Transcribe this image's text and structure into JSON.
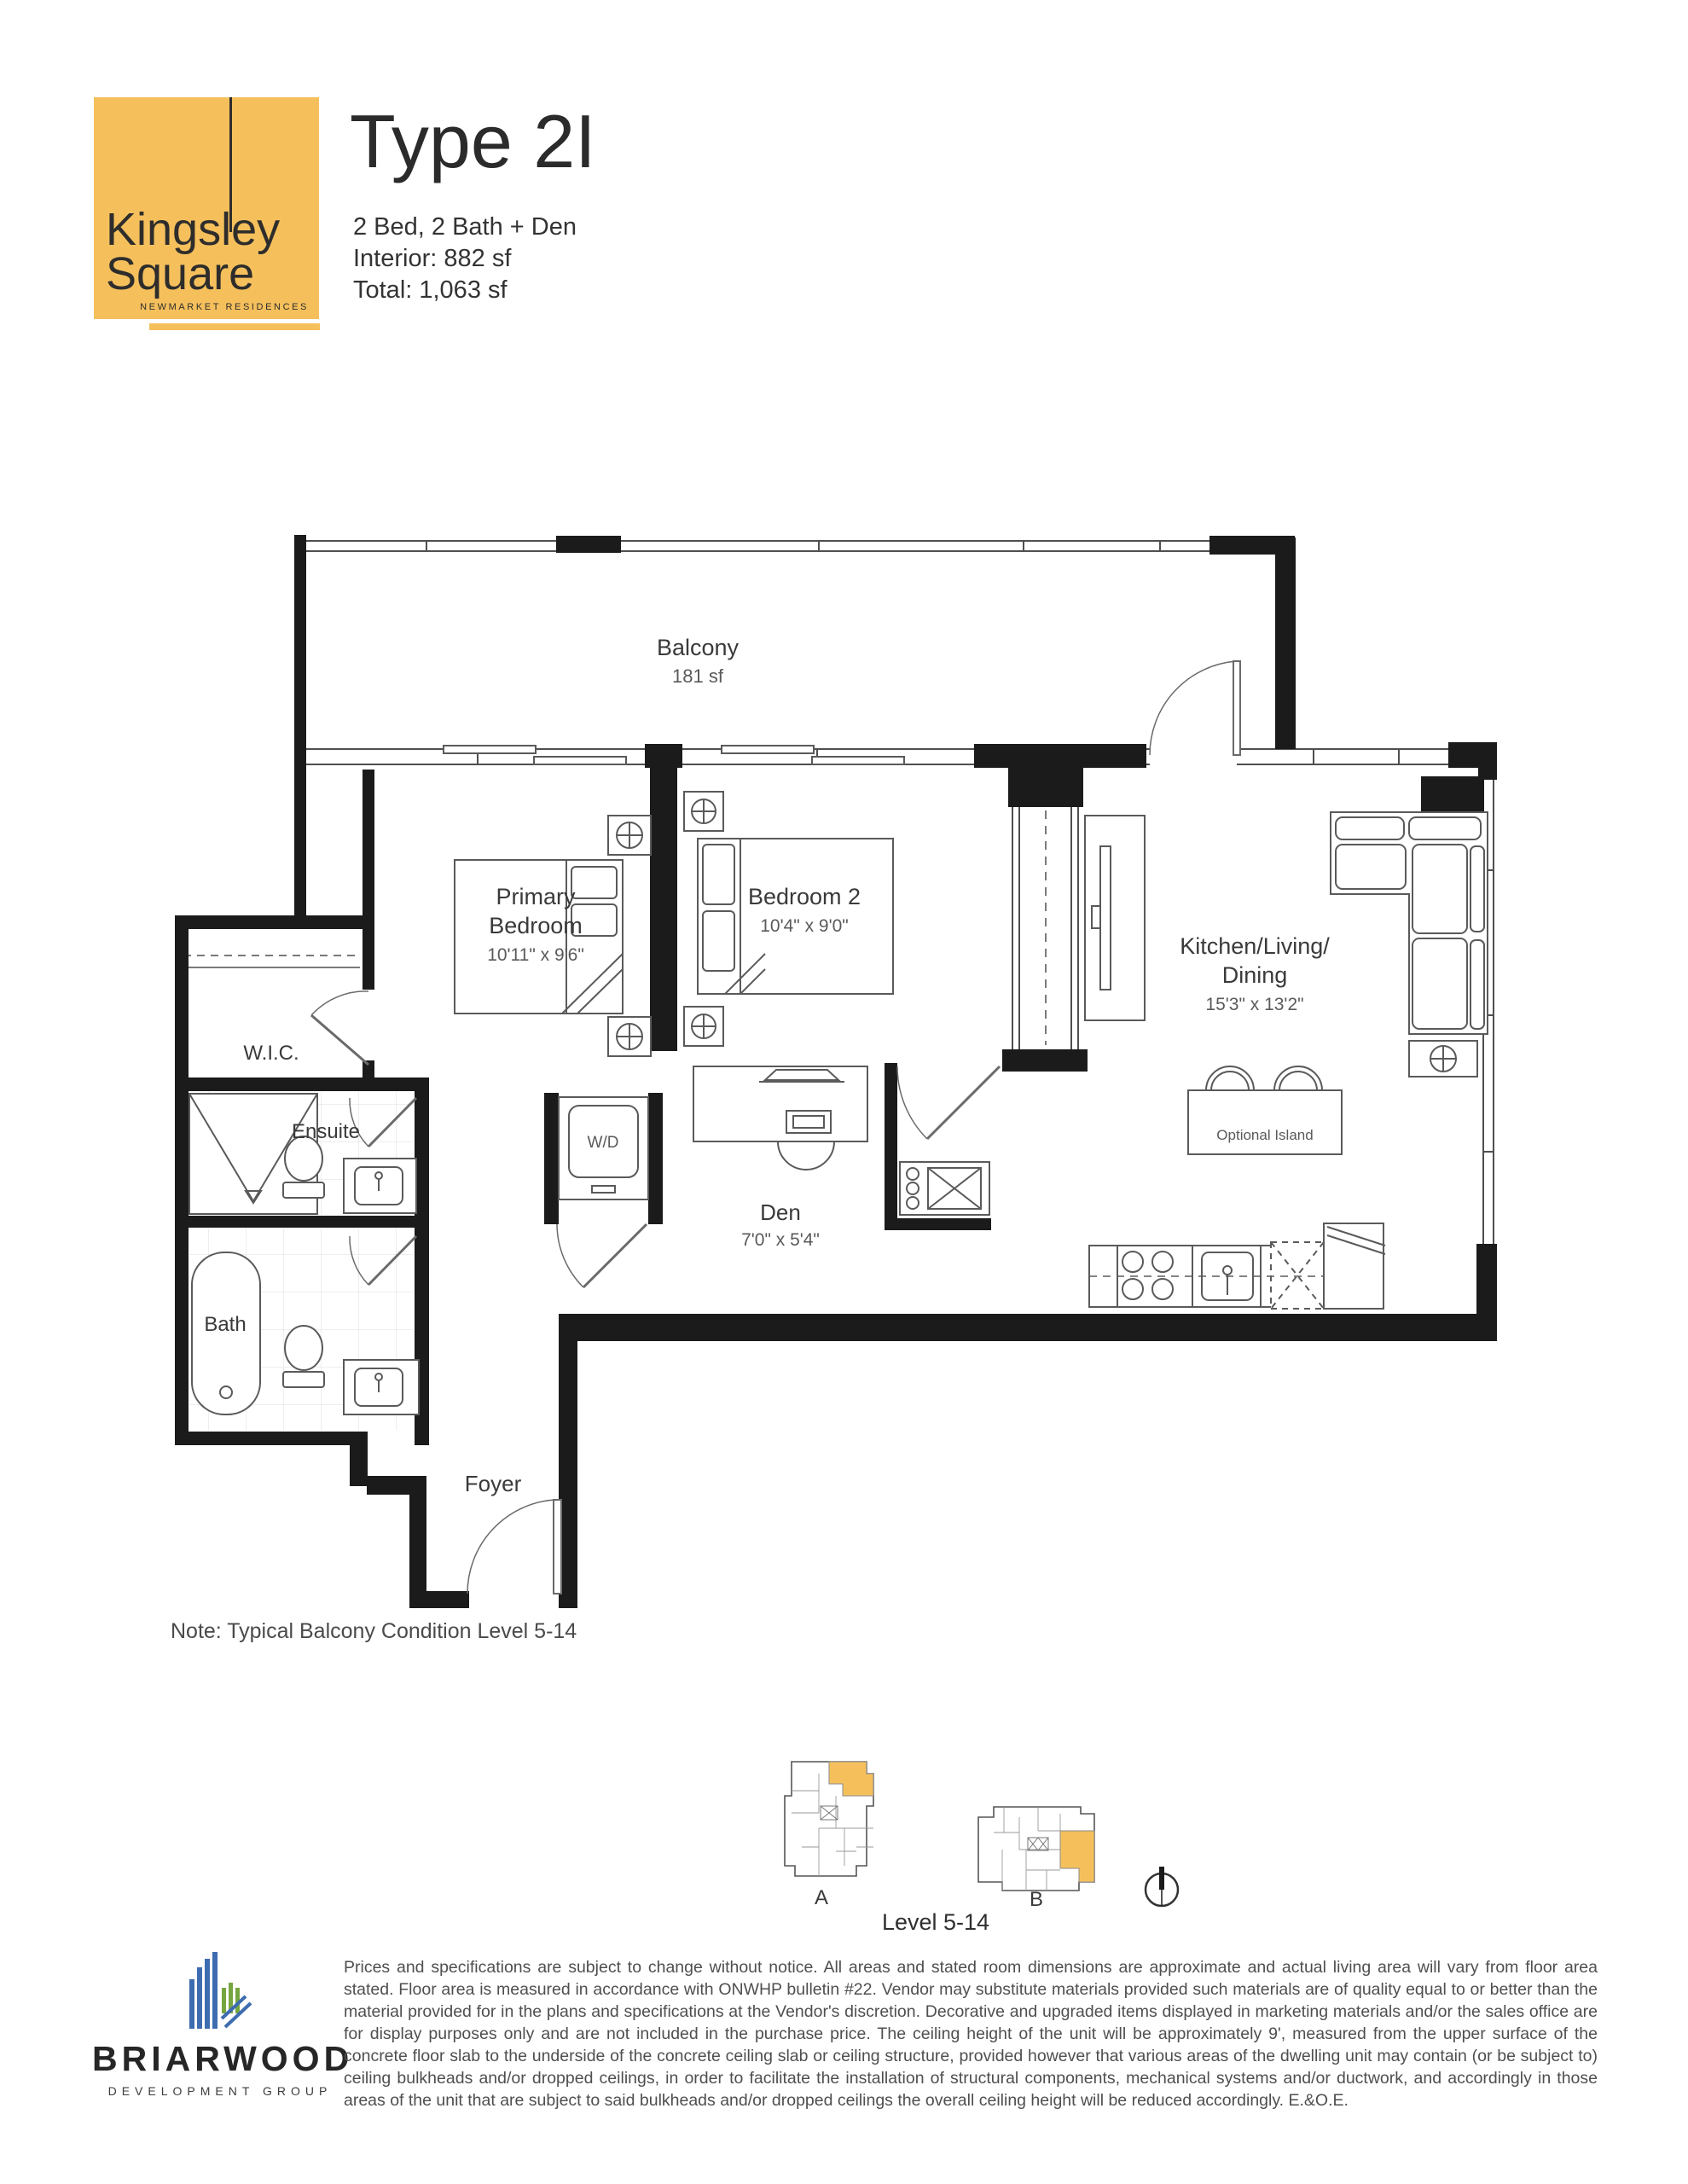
{
  "colors": {
    "accent_yellow": "#F5C05C",
    "wall_black": "#1b1b1b",
    "line_gray": "#4f4f4f",
    "text_dark": "#2b2b2b",
    "logo_blue": "#3e6cb0",
    "logo_green": "#76a63f"
  },
  "header": {
    "logo": {
      "line1": "Kingsley",
      "line2": "Square",
      "tagline": "NEWMARKET RESIDENCES"
    },
    "title": "Type 2I",
    "spec_line": "2 Bed, 2 Bath + Den",
    "interior_line": "Interior: 882 sf",
    "total_line": "Total: 1,063 sf"
  },
  "plan": {
    "rooms": {
      "balcony": {
        "name": "Balcony",
        "area": "181 sf"
      },
      "primary": {
        "line1": "Primary",
        "line2": "Bedroom",
        "dims": "10'11\" x 9'6\""
      },
      "bedroom2": {
        "name": "Bedroom 2",
        "dims": "10'4\" x 9'0\""
      },
      "kitchen": {
        "line1": "Kitchen/Living/",
        "line2": "Dining",
        "dims": "15'3\" x 13'2\""
      },
      "wic": {
        "name": "W.I.C."
      },
      "ensuite": {
        "name": "Ensuite"
      },
      "bath": {
        "name": "Bath"
      },
      "den": {
        "name": "Den",
        "dims": "7'0\" x 5'4\""
      },
      "foyer": {
        "name": "Foyer"
      },
      "laundry": {
        "name": "W/D"
      },
      "island": {
        "name": "Optional Island"
      }
    },
    "note": "Note: Typical Balcony Condition Level 5-14"
  },
  "keyplan": {
    "building_a": "A",
    "building_b": "B",
    "level": "Level 5-14"
  },
  "footer": {
    "brand_name": "BRIARWOOD",
    "brand_tagline": "DEVELOPMENT GROUP",
    "disclaimer": "Prices and specifications are subject to change without notice. All areas and stated room dimensions are approximate and actual living area will vary from floor area stated. Floor area is measured in accordance with ONWHP bulletin #22. Vendor may substitute materials provided such materials are of quality equal to or better than the material provided for in the plans and specifications at the Vendor's discretion. Decorative and upgraded items displayed in marketing materials and/or the sales office are for display purposes only and are not included in the purchase price. The ceiling height of the unit will be approximately 9', measured from the upper surface of the concrete floor slab to the underside of the concrete ceiling slab or ceiling structure, provided however that various areas of the dwelling unit may contain (or be subject to) ceiling bulkheads and/or dropped ceilings, in order to facilitate the installation of structural components, mechanical systems and/or ductwork, and accordingly in those areas of the unit that are subject to said bulkheads and/or dropped ceilings the overall ceiling height will be reduced accordingly. E.&O.E."
  }
}
